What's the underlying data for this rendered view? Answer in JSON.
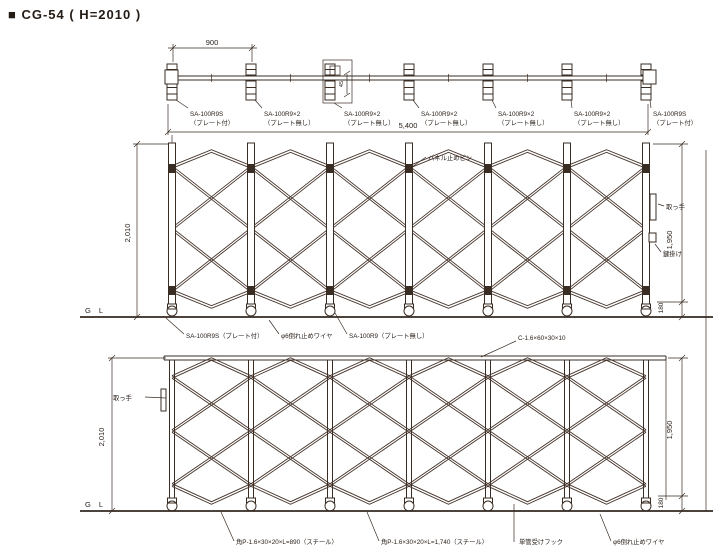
{
  "colors": {
    "background": "#ffffff",
    "line": "#3a2d24",
    "text": "#2a211b"
  },
  "title": {
    "text": "■ CG-54 ( H=2010 )"
  },
  "plan": {
    "dim_bay": "900",
    "dim_total": "5,400",
    "dim_detail": "45",
    "casters": [
      {
        "line1": "SA-100R9S",
        "line2": "（プレート付）"
      },
      {
        "line1": "SA-100R9×2",
        "line2": "（プレート無し）"
      },
      {
        "line1": "SA-100R9×2",
        "line2": "（プレート無し）"
      },
      {
        "line1": "SA-100R9×2",
        "line2": "（プレート無し）"
      },
      {
        "line1": "SA-100R9×2",
        "line2": "（プレート無し）"
      },
      {
        "line1": "SA-100R9×2",
        "line2": "（プレート無し）"
      },
      {
        "line1": "SA-100R9S",
        "line2": "（プレート付）"
      }
    ]
  },
  "front": {
    "dim_height": "2,010",
    "dim_body": "1,950",
    "dim_base": "180",
    "gl": "G L",
    "labels": {
      "panel_pin": "パネル止めピン",
      "handle": "取っ手",
      "latch": "鍵掛け",
      "caster_plate": "SA-100R9S（プレート付）",
      "tip_wire": "φ6倒れ止めワイヤ",
      "caster_noplate": "SA-100R9（プレート無し）"
    }
  },
  "rear": {
    "dim_height": "2,010",
    "dim_body": "1,950",
    "dim_base": "180",
    "gl": "G L",
    "labels": {
      "channel": "C-1.6×60×30×10",
      "handle": "取っ手",
      "pipe_short": "角P-1.6×30×20×L=890（スチール）",
      "pipe_long": "角P-1.6×30×20×L=1,740（スチール）",
      "pipe_hook": "単管受けフック",
      "tip_wire": "φ6倒れ止めワイヤ"
    }
  }
}
